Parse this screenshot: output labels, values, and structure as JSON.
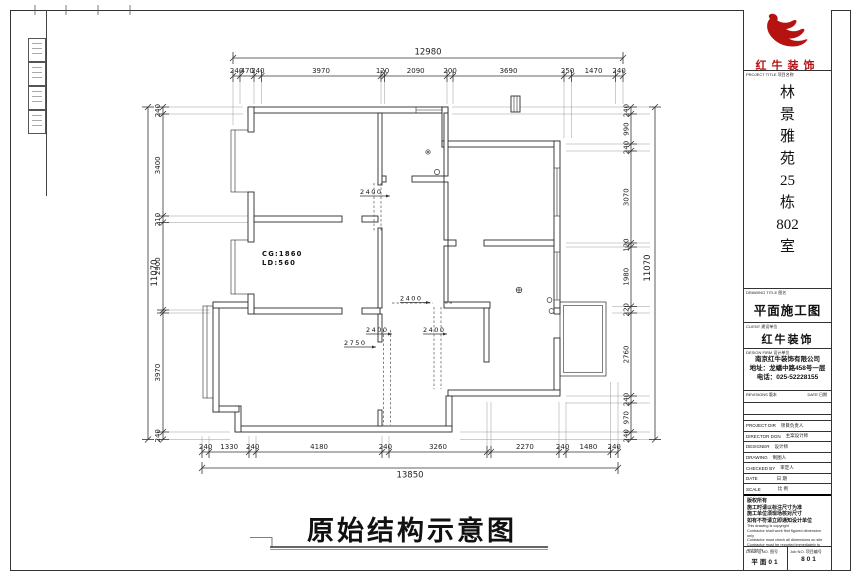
{
  "sheet": {
    "title": "原始结构示意图"
  },
  "logo": {
    "company": "红牛装饰",
    "color": "#b51212"
  },
  "tblock": {
    "project_title_label": "PROJECT TITLE 项目名称",
    "project_name_chars": [
      "林",
      "景",
      "雅",
      "苑",
      "25",
      "栋",
      "802",
      "室"
    ],
    "drawing_title_label": "DRAWING TITLE 图名",
    "drawing_title": "平面施工图",
    "client_label": "CLIENT 建设单位",
    "client": "红牛装饰",
    "design_firm_label": "DESIGN FIRM 设计单位",
    "design_firm_lines": [
      "南京红牛装饰有限公司",
      "地址：龙蟠中路458号一层",
      "电话：025-52228155"
    ],
    "revisions_label": "REVISIONS 版本",
    "date_label": "DATE 日期",
    "rows": [
      {
        "en": "PROJECT DIR",
        "cn": "项目负责人"
      },
      {
        "en": "DIRECTOR DGN",
        "cn": "主案设计师"
      },
      {
        "en": "DESIGNER",
        "cn": "设计师"
      },
      {
        "en": "DRAWING",
        "cn": "制图人"
      },
      {
        "en": "CHECKED BY",
        "cn": "审定人"
      },
      {
        "en": "DATE",
        "cn": "日 期"
      },
      {
        "en": "SCALE",
        "cn": "比 例"
      }
    ],
    "notes_cn": [
      "版权所有",
      "施工时请以标注尺寸为准",
      "施工单位须现场核对尺寸",
      "如有不符请立即通知设计单位"
    ],
    "notes_en": [
      "This drawing is copyright",
      "Contractor shall work first figured dimension only",
      "Contractor must check all dimensions on site",
      "Contractor must be reported immediately to architects"
    ],
    "drawing_no_label": "Drawing NO. 图号",
    "drawing_no": "平面01",
    "job_no_label": "Job NO. 项目编号",
    "job_no": "801"
  },
  "plan": {
    "dims": {
      "top_total": "12980",
      "top": [
        "240",
        "470",
        "240",
        "3970",
        "120",
        "2090",
        "200",
        "3690",
        "250",
        "1470",
        "240"
      ],
      "bottom_total": "13850",
      "bottom": [
        "240",
        "1330",
        "240",
        "4180",
        "240",
        "3260",
        "2270",
        "240",
        "1480",
        "240"
      ],
      "left_total": "11070",
      "left": [
        "240",
        "3400",
        "210",
        "2900",
        "3970",
        "240"
      ],
      "right_total": "11070",
      "right": [
        "240",
        "990",
        "240",
        "3070",
        "120",
        "1980",
        "220",
        "2760",
        "240",
        "970",
        "240"
      ]
    },
    "annotations": {
      "a1": "2400",
      "a2": "2400",
      "a3": "2400",
      "a4": "2400",
      "a5": "2750",
      "cg": "CG:1860",
      "ld": "LD:560"
    }
  }
}
